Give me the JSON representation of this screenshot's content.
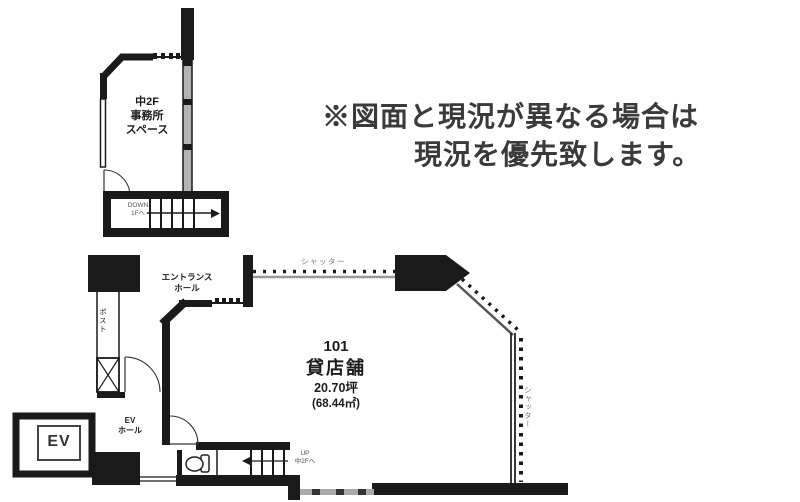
{
  "disclaimer": {
    "line1": "※図面と現況が異なる場合は",
    "line2": "現況を優先致します。"
  },
  "mezzanine": {
    "label_line1": "中2F",
    "label_line2": "事務所",
    "label_line3": "スペース",
    "stairs_direction": "DOWN",
    "stairs_destination": "1Fへ"
  },
  "main_floor": {
    "entrance_label_line1": "エントランス",
    "entrance_label_line2": "ホール",
    "mailbox_label": "ポスト",
    "shutter_top_label": "シャッター",
    "shutter_right_label": "シャッター",
    "elevator_label": "EV",
    "elevator_hall_line1": "EV",
    "elevator_hall_line2": "ホール",
    "unit": {
      "number": "101",
      "type": "貸店舗",
      "area_tsubo": "20.70坪",
      "area_sqm": "(68.44㎡)"
    },
    "stairs_direction": "UP",
    "stairs_destination": "中2Fへ"
  },
  "colors": {
    "wall": "#1a1a1a",
    "window_fill": "#b3b3b3",
    "shutter_gray": "#999999",
    "disclaimer_text": "#3a3a3a"
  }
}
